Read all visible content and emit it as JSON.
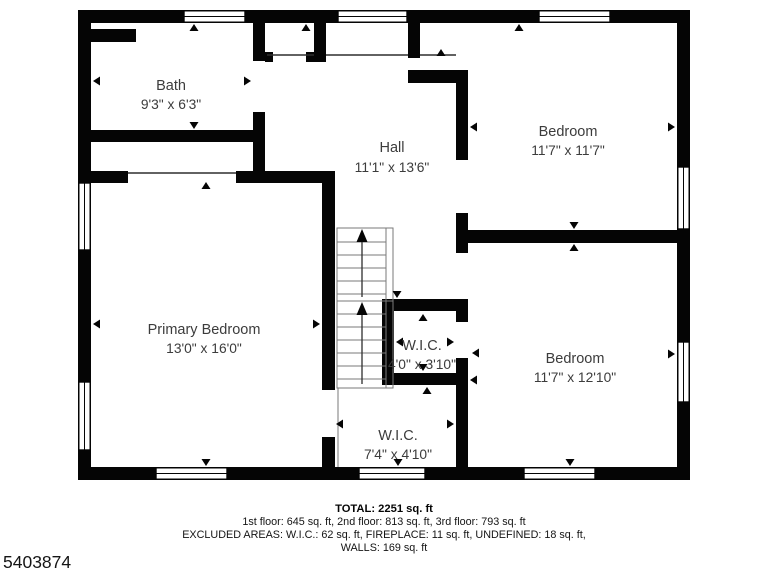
{
  "palette": {
    "background": "#ffffff",
    "wall": "#050505",
    "label_text": "#3c3c3c",
    "summary_text": "#141414"
  },
  "rooms": {
    "bath": {
      "name": "Bath",
      "dims": "9'3\" x 6'3\""
    },
    "hall": {
      "name": "Hall",
      "dims": "11'1\" x 13'6\""
    },
    "bedroom_top": {
      "name": "Bedroom",
      "dims": "11'7\" x 11'7\""
    },
    "primary_bedroom": {
      "name": "Primary Bedroom",
      "dims": "13'0\" x 16'0\""
    },
    "wic_upper": {
      "name": "W.I.C.",
      "dims": "4'0\" x 3'10\""
    },
    "bedroom_bottom": {
      "name": "Bedroom",
      "dims": "11'7\" x 12'10\""
    },
    "wic_lower": {
      "name": "W.I.C.",
      "dims": "7'4\" x 4'10\""
    }
  },
  "summary": {
    "total": "TOTAL: 2251 sq. ft",
    "floors": "1st floor: 645 sq. ft, 2nd floor: 813 sq. ft, 3rd floor: 793 sq. ft",
    "excluded": "EXCLUDED AREAS: W.I.C.: 62 sq. ft, FIREPLACE: 11 sq. ft, UNDEFINED: 18 sq. ft,",
    "walls": "WALLS: 169 sq. ft"
  },
  "listing_id": "5403874"
}
